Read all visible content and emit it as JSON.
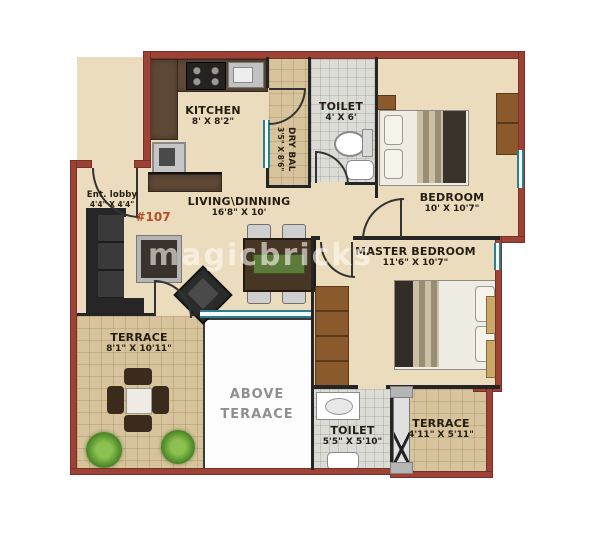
{
  "watermark": "magicbricks",
  "unit_number": "#107",
  "rooms": {
    "kitchen": {
      "label": "KITCHEN",
      "dims": "8' X 8'2\""
    },
    "dry_bal": {
      "label": "DRY BAL",
      "dims": "3'5\" X 8'6\""
    },
    "toilet_top": {
      "label": "TOILET",
      "dims": "4' X 6'"
    },
    "bedroom": {
      "label": "BEDROOM",
      "dims": "10' X 10'7\""
    },
    "ent_lobby": {
      "label": "Ent. lobby",
      "dims": "4'4\" X 4'4\""
    },
    "living": {
      "label": "LIVING\\DINNING",
      "dims": "16'8\" X 10'"
    },
    "master_bedroom": {
      "label": "MASTER BEDROOM",
      "dims": "11'6\" X 10'7\""
    },
    "terrace_left": {
      "label": "TERRACE",
      "dims": "8'1\" X 10'11\""
    },
    "above_terrace": {
      "line1": "ABOVE",
      "line2": "TERAACE"
    },
    "toilet_bottom": {
      "label": "TOILET",
      "dims": "5'5\" X 5'10\""
    },
    "terrace_right": {
      "label": "TERRACE",
      "dims": "4'11\" X 5'11\""
    }
  },
  "colors": {
    "exterior_wall": "#9c4237",
    "interior_wall": "#252525",
    "floor_beige": "#ecdcbe",
    "terrace_tan": "#d7c49c",
    "toilet_gray": "#dcdcd6",
    "window_teal": "#2e7f8e",
    "unit_accent": "#b44f28"
  }
}
